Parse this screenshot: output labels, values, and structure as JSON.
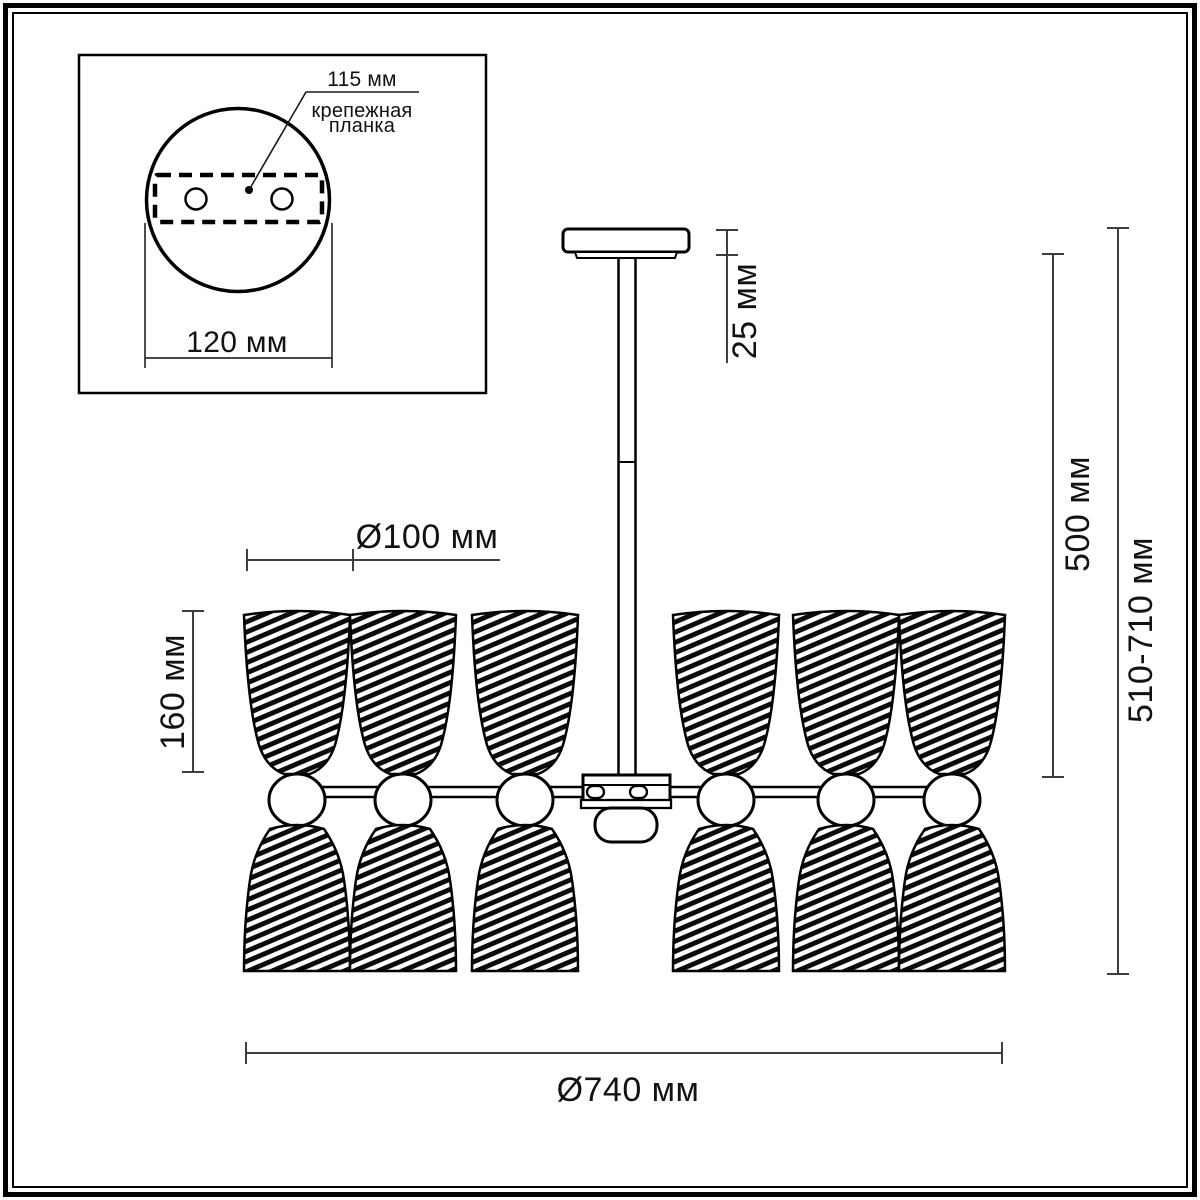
{
  "drawing": {
    "type": "chandelier-dimension-drawing",
    "background": "#ffffff",
    "line_color": "#000000",
    "dimension_line_color": "#3d3d3d"
  },
  "inset": {
    "hole_spacing_label": "115 мм",
    "plate_label_line1": "крепежная",
    "plate_label_line2": "планка",
    "canopy_diameter_label": "120 мм"
  },
  "dimensions": {
    "shade_diameter": "Ø100 мм",
    "shade_height": "160 мм",
    "canopy_height": "25 мм",
    "rod_length": "500 мм",
    "total_height": "510-710 мм",
    "total_diameter": "Ø740 мм"
  }
}
